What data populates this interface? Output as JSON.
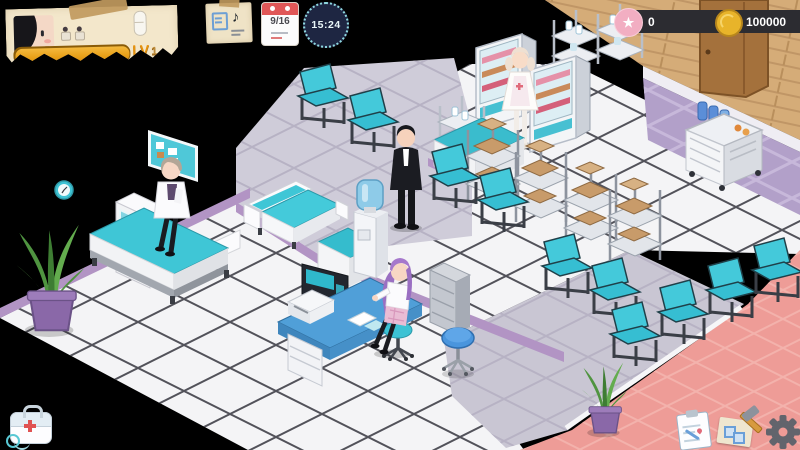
{
  "hud": {
    "player_card": {
      "level_label": "LV",
      "level_value": "1",
      "xp_percent": 100
    },
    "note_icon": {
      "music_note": "♪"
    },
    "calendar": {
      "date": "9/16"
    },
    "clock": {
      "time": "15:24"
    },
    "star_counter": {
      "glyph": "★",
      "value": "0"
    },
    "coin_counter": {
      "value": "100000"
    },
    "icons": {
      "top_left": "player-avatar",
      "capsule": "capsule-icon",
      "schedule_note": "music-note-paper-icon",
      "calendar": "calendar-icon",
      "clock": "clock-icon",
      "star": "star-icon",
      "coin": "coin-icon",
      "bottom_left": "medkit-icon",
      "bottom_right": [
        "clipboard-icon",
        "hammer-build-icon",
        "gear-icon"
      ]
    },
    "colors": {
      "teal_accent": "#3ec6d8",
      "lavender_wall": "#b294c4",
      "pink_floor": "#ee9c97",
      "wood_floor": "#d5ac78",
      "hud_pill_bg": "#2c2c31",
      "xp_orange": "#e9a21b",
      "star_pink": "#f2aec2",
      "coin_gold": "#e8b42a"
    }
  }
}
